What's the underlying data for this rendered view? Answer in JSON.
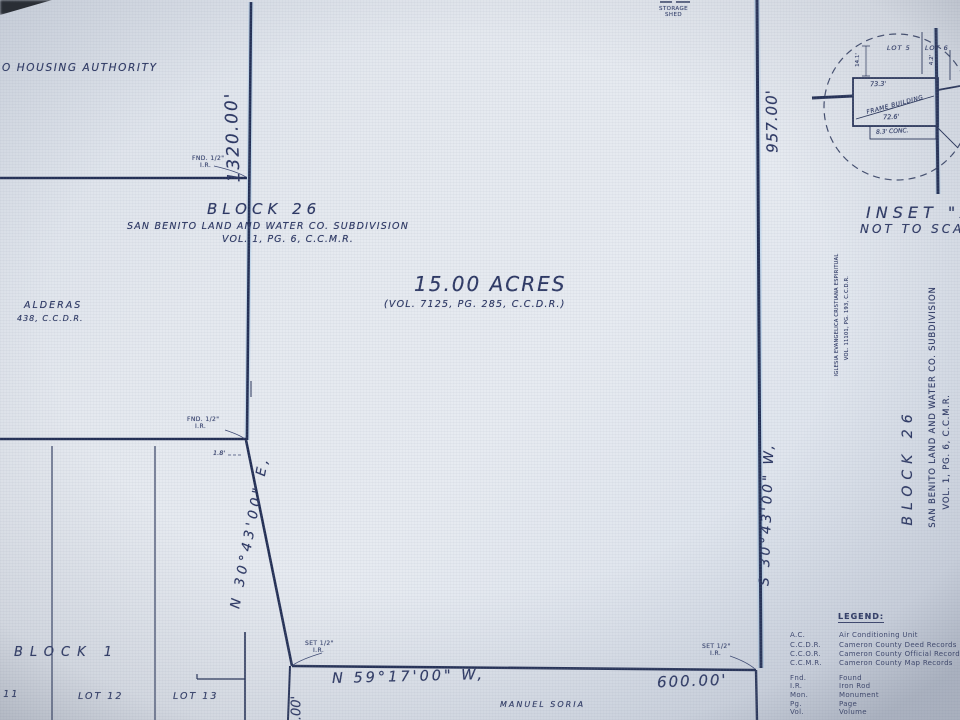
{
  "colors": {
    "ink": "#2c3763",
    "line": "#232f55",
    "background": "#e2e7ee"
  },
  "neighbors": {
    "housing_authority": "O HOUSING AUTHORITY",
    "balderas_line1": "ALDERAS",
    "balderas_line2": "438, C.C.D.R.",
    "manuel_soria": "MANUEL SORIA",
    "iglesia_line1": "IGLESIA EVANGELICA CRISTIANA ESPIRITUAL",
    "iglesia_line2": "VOL. 11101, PG. 193, C.C.D.R."
  },
  "block26_header": {
    "title": "BLOCK 26",
    "subdivision": "SAN BENITO LAND AND WATER CO. SUBDIVISION",
    "volume": "VOL. 1, PG. 6, C.C.M.R."
  },
  "parcel": {
    "area": "15.00 ACRES",
    "deed": "(VOL. 7125, PG. 285, C.C.D.R.)",
    "west_dim": "1320.00'",
    "west_bearing": "N 30°43'00\" E,",
    "east_dim": "957.00'",
    "east_bearing": "S 30°43'00\" W,",
    "south_bearing": "N 59°17'00\" W,",
    "south_dim": "600.00'",
    "south_partial_dim": ".00'",
    "offset_note": "1.8'"
  },
  "right_block": {
    "block": "BLOCK 26",
    "subdivision": "SAN BENITO LAND AND WATER CO. SUBDIVISION",
    "volume": "VOL. 1, PG. 6, C.C.M.R."
  },
  "markers": {
    "fnd": "FND. 1/2\"",
    "set": "SET 1/2\"",
    "ir": "I.R."
  },
  "structures": {
    "storage_line1": "STORAGE",
    "storage_line2": "SHED"
  },
  "block1": {
    "title": "BLOCK 1",
    "lot11": "LOT 11",
    "lot12": "LOT 12",
    "lot13": "LOT 13"
  },
  "inset": {
    "title": "INSET \"A\"",
    "scale_note": "NOT TO SCALE",
    "lot5": "LOT 5",
    "lot6": "LOT 6",
    "building": "FRAME BUILDING",
    "dim_top": "73.3'",
    "dim_bottom": "72.6'",
    "dim_conc": "8.3' CONC.",
    "dim_left": "14.1'",
    "dim_right": "4.2'"
  },
  "legend": {
    "title": "LEGEND:",
    "rows": [
      {
        "abbr": "A.C.",
        "desc": "Air Conditioning Unit"
      },
      {
        "abbr": "C.C.D.R.",
        "desc": "Cameron County Deed Records"
      },
      {
        "abbr": "C.C.O.R.",
        "desc": "Cameron County Official Records"
      },
      {
        "abbr": "C.C.M.R.",
        "desc": "Cameron County Map Records"
      },
      {
        "abbr": "Fnd.",
        "desc": "Found"
      },
      {
        "abbr": "I.R.",
        "desc": "Iron Rod"
      },
      {
        "abbr": "Mon.",
        "desc": "Monument"
      },
      {
        "abbr": "Pg.",
        "desc": "Page"
      },
      {
        "abbr": "Vol.",
        "desc": "Volume"
      }
    ]
  }
}
